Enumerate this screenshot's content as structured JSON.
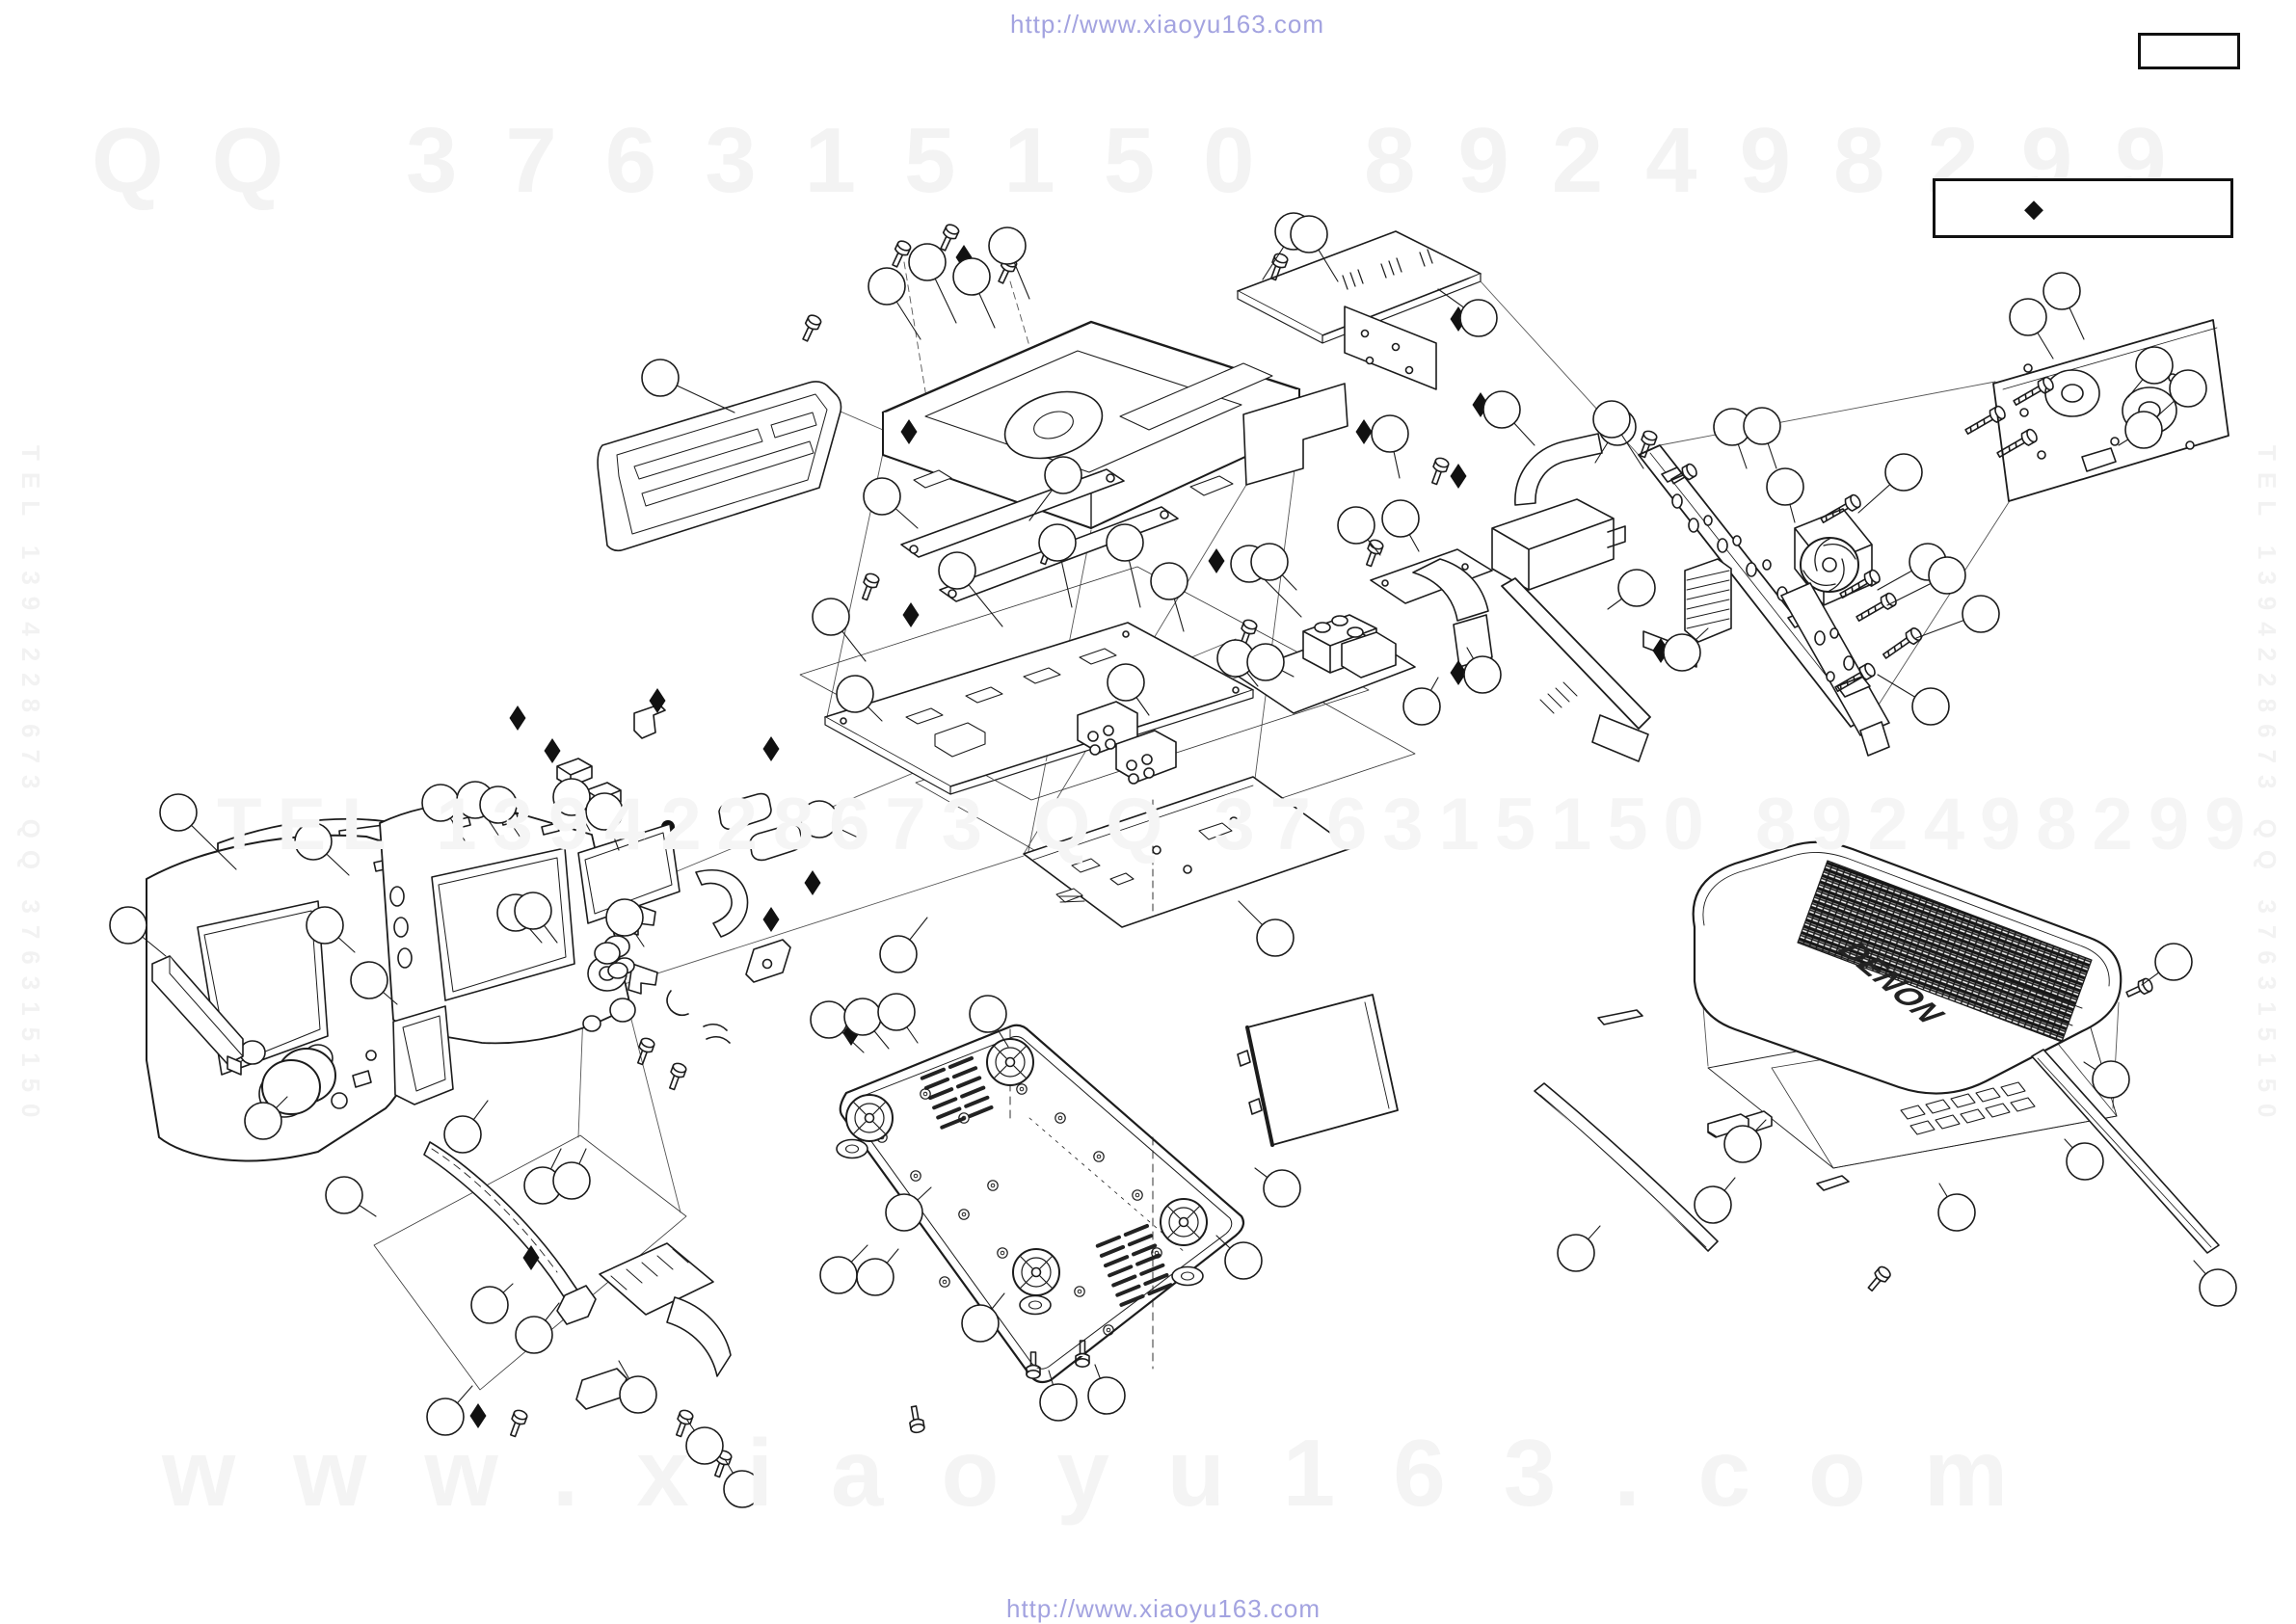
{
  "header": {
    "url": "http://www.xiaoyu163.com"
  },
  "footer": {
    "url": "http://www.xiaoyu163.com"
  },
  "legend": {
    "symbol": "◆"
  },
  "cover": {
    "brand": "DENON"
  },
  "watermarks": {
    "row1_left": "QQ 376315150",
    "row1_right": "892498299",
    "row2": "TEL 1394228673 QQ 376315150 892498299",
    "row3": "www.xiaoyu163.com",
    "side_left": "TEL 1394228673 QQ 376315150",
    "side_right": "TEL 1394228673 QQ 376315150"
  },
  "colors": {
    "url_text": "#a3a3e0",
    "watermark": "#f3f3f3",
    "line_art": "#1c1c1c",
    "paper": "#ffffff"
  }
}
